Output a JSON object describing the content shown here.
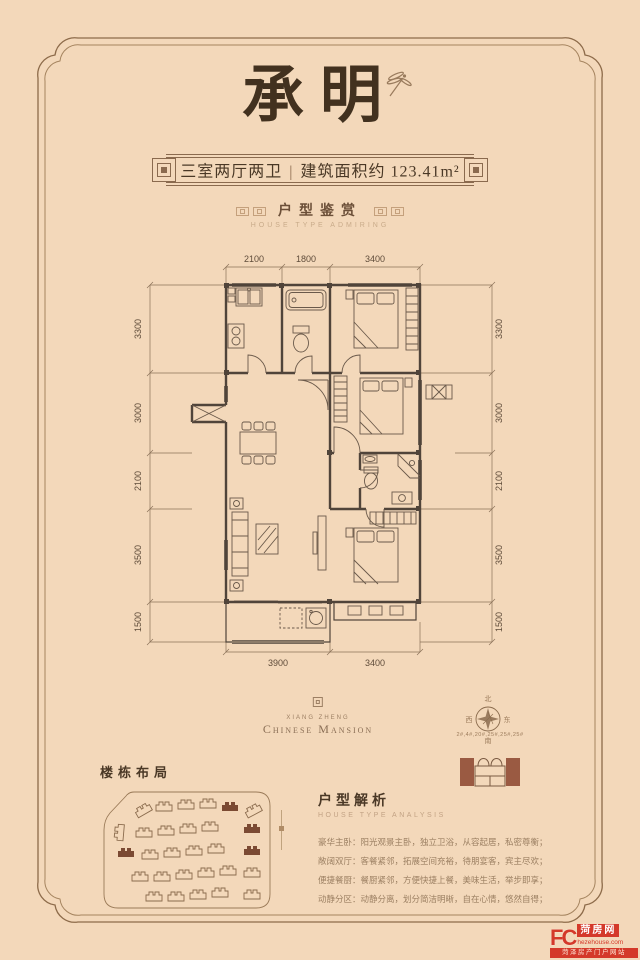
{
  "page": {
    "title_cn": "承明"
  },
  "banner": {
    "rooms": "三室两厅两卫",
    "separator": "|",
    "area": "建筑面积约 123.41m²"
  },
  "appreciation": {
    "title": "户型鉴赏",
    "subtitle": "HOUSE TYPE ADMIRING"
  },
  "floorplan": {
    "dims_top": [
      "2100",
      "1800",
      "3400"
    ],
    "dims_bottom": [
      "3900",
      "3400"
    ],
    "dims_left": [
      "3300",
      "3000",
      "2100",
      "3500",
      "1500"
    ],
    "dims_right": [
      "3300",
      "3000",
      "2100",
      "3500",
      "1500"
    ]
  },
  "brand": {
    "name_pinyin": "XIANG ZHENG",
    "name_en": "Chinese Mansion"
  },
  "compass": {
    "north": "北",
    "south": "南",
    "west": "西",
    "east": "东"
  },
  "locator": {
    "buildings": "2#,4#,20#,25#,25#,25#"
  },
  "layout_section": {
    "title": "楼栋布局"
  },
  "analysis": {
    "title": "户型解析",
    "subtitle": "HOUSE TYPE ANALYSIS",
    "lines": [
      "豪华主卧：阳光观景主卧，独立卫浴，从容起居，私密尊衡；",
      "敞阔双厅：客餐紧邻，拓展空间充裕，待朋宴客，宾主尽欢；",
      "便捷餐厨：餐厨紧邻，方便快捷上餐，美味生活，举步即享；",
      "动静分区：动静分离，划分简洁明晰，自在心情，悠然自得；"
    ]
  },
  "watermark": {
    "logo": "FC",
    "site_cn": "菏房网",
    "url": "hezehouse.com",
    "tagline": "菏泽房产门户网站"
  }
}
